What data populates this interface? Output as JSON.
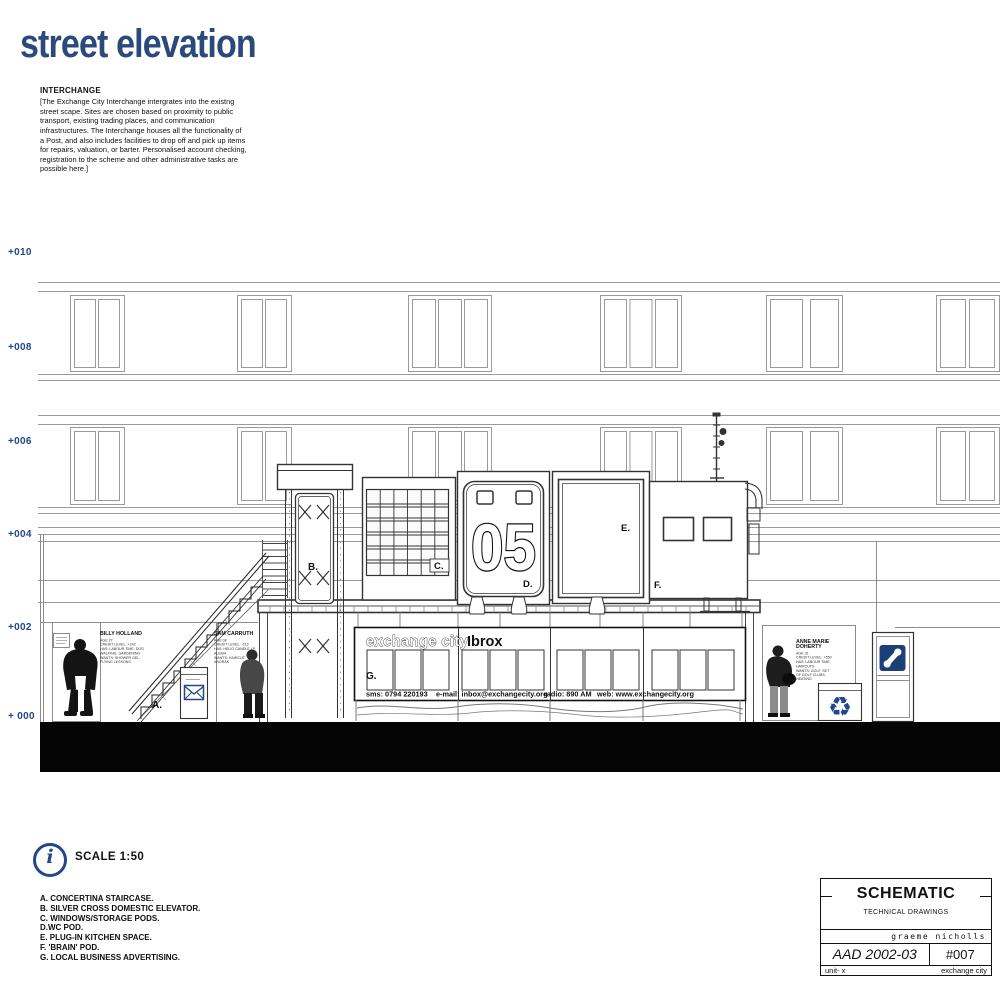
{
  "accent": "#2b4a7c",
  "icon_blue": "#24468c",
  "title": "street elevation",
  "interchange": {
    "heading": "INTERCHANGE",
    "body": "[The Exchange City Interchange intergrates into the existng\nstreet scape. Sites are chosen based on proximity to public\ntransport, existing trading places, and communication\ninfrastructures. The Interchange houses all the functionality of\na Post, and also includes facilities to drop off and pick up items\nfor repairs, valuation, or barter. Personalised account checking,\nregistration to the scheme and other administrative tasks are\npossible here.]"
  },
  "markers": [
    "+010",
    "+008",
    "+006",
    "+004",
    "+002",
    "+ 000"
  ],
  "callouts": {
    "a": "A.",
    "b": "B.",
    "c": "C.",
    "d": "D.",
    "e": "E.",
    "f": "F.",
    "g": "G.",
    "pod_number": "05"
  },
  "signage": {
    "brand": "exchange city",
    "location": "Ibrox",
    "contact": {
      "sms": "sms: 0794 220193",
      "email": "e-mail: inbox@exchangecity.org",
      "radio": "radio: 890 AM",
      "web": "web: www.exchangecity.org"
    }
  },
  "people": {
    "billy": {
      "name": "BILLY HOLLAND",
      "stats": "AGE 27\nCREDIT LEVEL: +242\nHAS: LABOUR TIME, DOG\nWALKING, GARDENING\nWANTS: SHOWER GEL,\nFLYING LESSONS"
    },
    "sam": {
      "name": "SAM CARRUTH",
      "stats": "AGE 08\nCREDIT LEVEL: -212\nHAS: HELIO CANDLE LP,\nALBUM\nWANTS: HAIRCUT,\nANORAK"
    },
    "anne": {
      "name": "ANNE MARIE\nDOHERTY",
      "stats": "AGE 31\nCREDIT LEVEL: +550\nHAS: LABOUR TIME,\nHAIRCUTS\nWANTS: GOLF, SET\nOF GOLF CLUBS,\nHEATING"
    }
  },
  "scale": {
    "label": "SCALE 1:50",
    "info_glyph": "i"
  },
  "legend": {
    "items": [
      "A. CONCERTINA STAIRCASE.",
      "B. SILVER CROSS DOMESTIC ELEVATOR.",
      "C. WINDOWS/STORAGE PODS.",
      "D.WC POD.",
      "E. PLUG-IN KITCHEN SPACE.",
      "F. 'BRAIN' POD.",
      "G. LOCAL BUSINESS ADVERTISING."
    ]
  },
  "title_block": {
    "title": "SCHEMATIC",
    "subtitle": "TECHNICAL DRAWINGS",
    "author": "graeme nicholls",
    "course": "AAD 2002-03",
    "sheet": "#007",
    "unit": "unit- x",
    "project": "exchange city"
  },
  "icons": {
    "recycle_glyph": "♻"
  }
}
